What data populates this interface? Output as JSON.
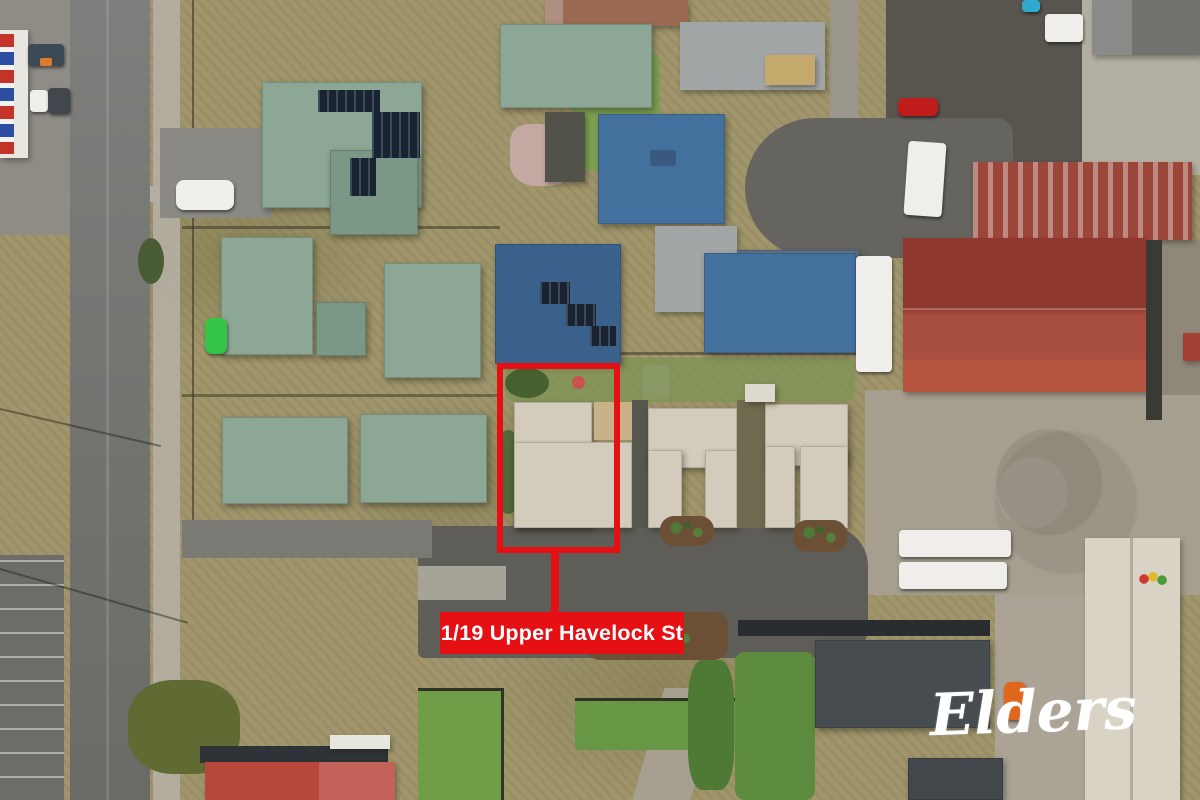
{
  "annotation": {
    "label": "1/19 Upper Havelock St"
  },
  "branding": {
    "logo_text": "Elders"
  },
  "colors": {
    "accent": "#e60f14",
    "label_text": "#ffffff",
    "logo": "#ffffff",
    "roof_green": "#8ca795",
    "roof_green_dark": "#7b9786",
    "roof_blue": "#44709e",
    "roof_blue_dark": "#3a608c",
    "roof_tan": "#d3ccbd",
    "roof_rust": "#9c4539",
    "roof_rust_bright": "#a84e3e",
    "roof_slate": "#474c51",
    "roof_coral": "#b7473b",
    "road": "#757573",
    "asphalt_dark": "#57554e",
    "driveway": "#5f5d57",
    "concrete": "#b3afa3",
    "gravel": "#a69e8f",
    "grass_dry": "#a1966b",
    "grass_green": "#6f9d48",
    "mulch": "#6b5036",
    "cream": "#d9d3c5",
    "white_vehicle": "#efeeea",
    "solar": "#1a2430",
    "shed_gray": "#a2a6a7",
    "blue_gray": "#5e7389"
  }
}
